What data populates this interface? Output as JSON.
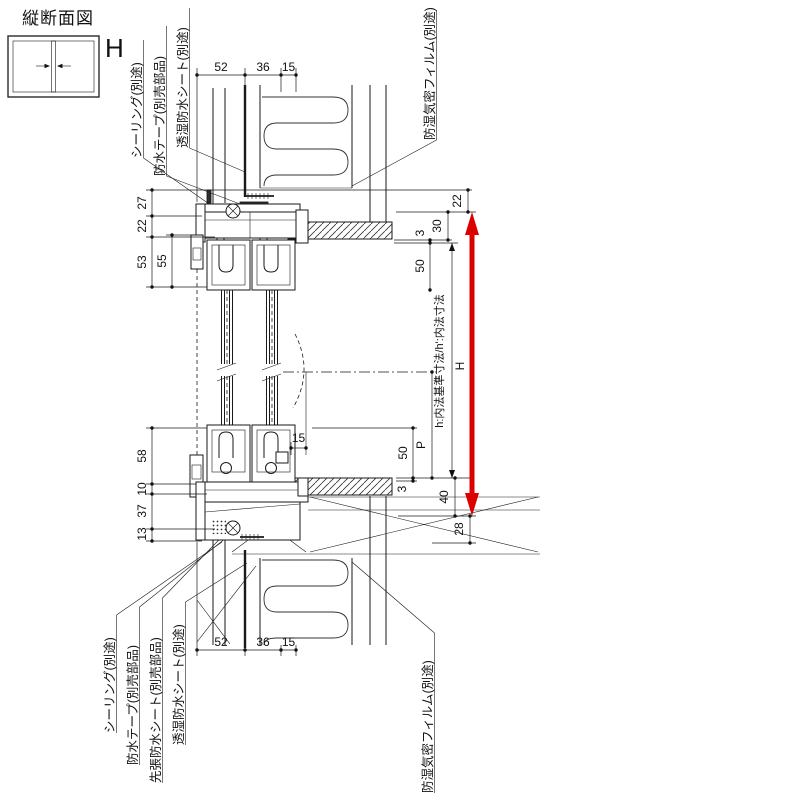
{
  "title": "縦断面図",
  "icon": {
    "label": "H"
  },
  "callouts": {
    "top_left": [
      "シーリング(別途)",
      "防水テープ(別売部品)",
      "透湿防水シート(別途)"
    ],
    "top_right": "防湿気密フィルム(別途)",
    "bottom_left": [
      "シーリング(別途)",
      "防水テープ(別売部品)",
      "先張防水シート(別売部品)",
      "透湿防水シート(別途)"
    ],
    "bottom_right": "防湿気密フィルム(別途)"
  },
  "dims": {
    "top": [
      "52",
      "36",
      "15"
    ],
    "bottom": [
      "52",
      "36",
      "15"
    ],
    "left_upper": [
      "27",
      "22",
      "53",
      "55"
    ],
    "left_lower": [
      "58",
      "10",
      "37",
      "13"
    ],
    "right_upper": [
      "22",
      "30",
      "3",
      "50"
    ],
    "right_lower": [
      "50",
      "3",
      "40",
      "28"
    ],
    "p_label": "P",
    "sill_inset": "15",
    "height_label": "H",
    "height_note": "h:内法基準寸法/h':内法寸法"
  },
  "colors": {
    "accent": "#dd0000",
    "line": "#1a1a1a"
  }
}
